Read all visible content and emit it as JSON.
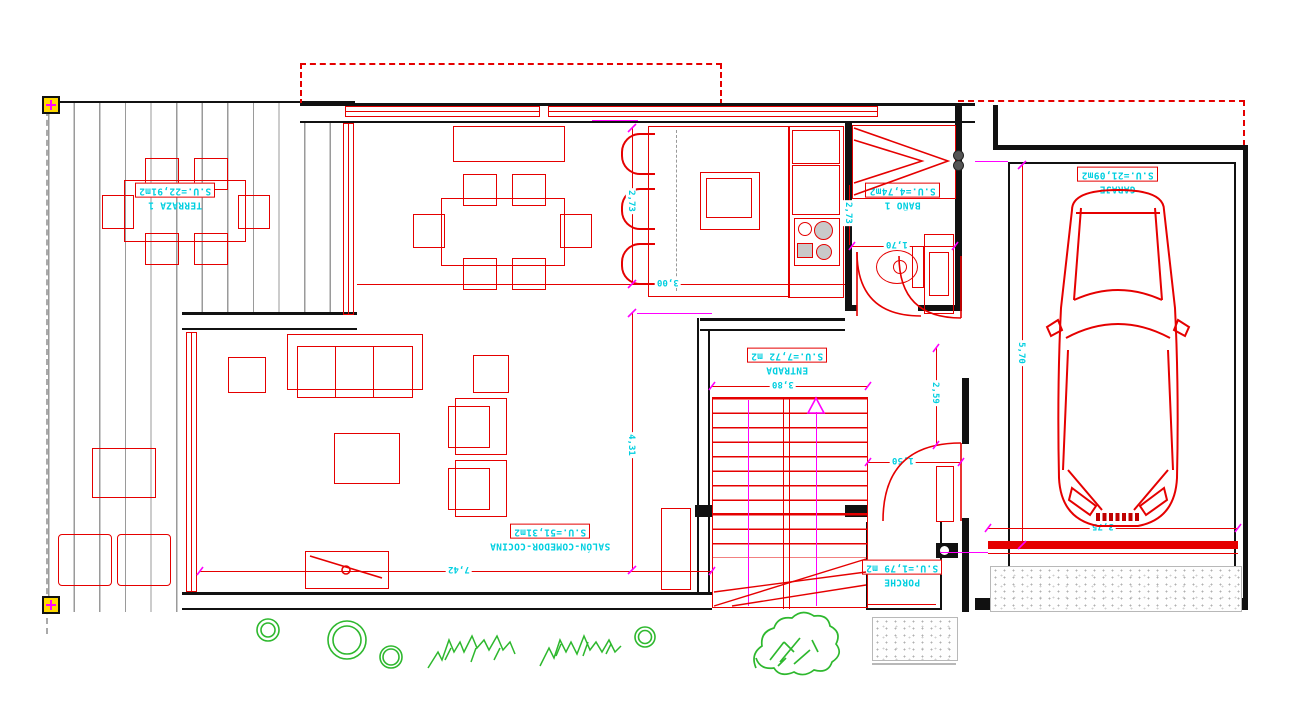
{
  "drawing_title": "planta baja - vivienda unifamiliar",
  "rooms": {
    "terraza": {
      "name": "TERRAZA 1",
      "area": "S.U.=22,91m2"
    },
    "garaje": {
      "name": "GARAJE",
      "area": "S.U.=21,09m2"
    },
    "bano": {
      "name": "BAÑO 1",
      "area": "S.U.=4,74m2"
    },
    "entrada": {
      "name": "ENTRADA",
      "area": "S.U.=7,72 m2"
    },
    "salon": {
      "name": "SALÓN-COMEDOR-COCINA",
      "area": "S.U.=51,31m2"
    },
    "porche": {
      "name": "PORCHE",
      "area": "S.U.=1,79 m2"
    }
  },
  "dims": {
    "cocina_alto": "2,73",
    "cocina_ancho": "3,00",
    "salon_alto": "4,31",
    "salon_ancho": "7,42",
    "entrada_ancho": "3,80",
    "pasillo_alto": "2,59",
    "puerta_paso": "1,50",
    "bano_ancho": "1,70",
    "bano_alto": "2,73",
    "garaje_alto": "5,70",
    "garaje_ancho": "3,75"
  },
  "colors": {
    "line_red": "#e50000",
    "text_cyan": "#00cfe0",
    "accent_magenta": "#ff00ff",
    "plant_green": "#2eb82e",
    "wall_black": "#111111",
    "deck_gray": "#9a9a9a",
    "marker_yellow": "#ffd900"
  }
}
